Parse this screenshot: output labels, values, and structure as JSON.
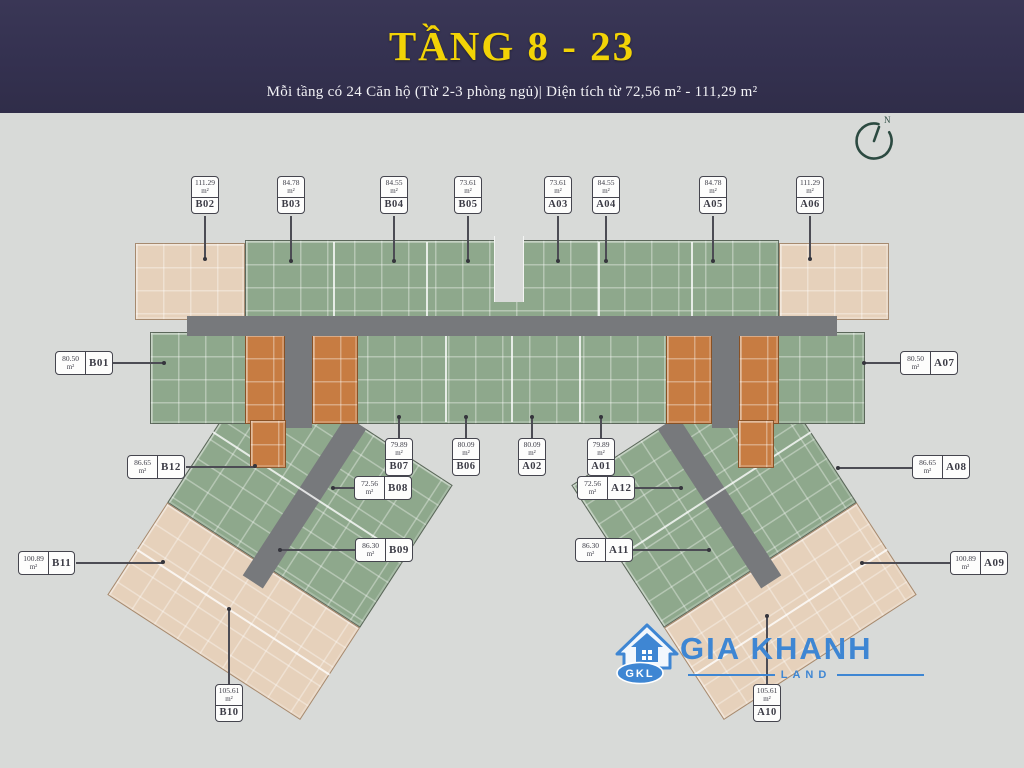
{
  "header": {
    "title": "TẦNG 8 - 23",
    "subtitle": "Mỗi tầng có 24 Căn hộ (Từ 2-3 phòng ngủ)| Diện tích từ 72,56 m²  - 111,29 m²"
  },
  "compass": {
    "label": "N"
  },
  "logo": {
    "name": "GIA KHANH",
    "sub": "LAND",
    "abbr": "GKL",
    "color": "#3e86d3"
  },
  "palette": {
    "header_bg": "#343150",
    "title_gold": "#f2d306",
    "plan_bg": "#d8dad8",
    "unit_green": "#8ea88c",
    "unit_beige": "#e6d1bb",
    "core_orange": "#c77c42",
    "corridor_gray": "#77797c",
    "logo_blue": "#3e86d3"
  },
  "units": [
    {
      "code": "B02",
      "area": "111.29",
      "unit": "m²",
      "style": "v",
      "box": {
        "x": 191,
        "y": 176
      },
      "line": {
        "x": 204,
        "y": 216,
        "w": 1.5,
        "h": 44
      },
      "dot": {
        "x": 205,
        "y": 259
      }
    },
    {
      "code": "B03",
      "area": "84.78",
      "unit": "m²",
      "style": "v",
      "box": {
        "x": 277,
        "y": 176
      },
      "line": {
        "x": 290,
        "y": 216,
        "w": 1.5,
        "h": 46
      },
      "dot": {
        "x": 291,
        "y": 261
      }
    },
    {
      "code": "B04",
      "area": "84.55",
      "unit": "m²",
      "style": "v",
      "box": {
        "x": 380,
        "y": 176
      },
      "line": {
        "x": 393,
        "y": 216,
        "w": 1.5,
        "h": 46
      },
      "dot": {
        "x": 394,
        "y": 261
      }
    },
    {
      "code": "B05",
      "area": "73.61",
      "unit": "m²",
      "style": "v",
      "box": {
        "x": 454,
        "y": 176
      },
      "line": {
        "x": 467,
        "y": 216,
        "w": 1.5,
        "h": 46
      },
      "dot": {
        "x": 468,
        "y": 261
      }
    },
    {
      "code": "A03",
      "area": "73.61",
      "unit": "m²",
      "style": "v",
      "box": {
        "x": 544,
        "y": 176
      },
      "line": {
        "x": 557,
        "y": 216,
        "w": 1.5,
        "h": 46
      },
      "dot": {
        "x": 558,
        "y": 261
      }
    },
    {
      "code": "A04",
      "area": "84.55",
      "unit": "m²",
      "style": "v",
      "box": {
        "x": 592,
        "y": 176
      },
      "line": {
        "x": 605,
        "y": 216,
        "w": 1.5,
        "h": 46
      },
      "dot": {
        "x": 606,
        "y": 261
      }
    },
    {
      "code": "A05",
      "area": "84.78",
      "unit": "m²",
      "style": "v",
      "box": {
        "x": 699,
        "y": 176
      },
      "line": {
        "x": 712,
        "y": 216,
        "w": 1.5,
        "h": 46
      },
      "dot": {
        "x": 713,
        "y": 261
      }
    },
    {
      "code": "A06",
      "area": "111.29",
      "unit": "m²",
      "style": "v",
      "box": {
        "x": 796,
        "y": 176
      },
      "line": {
        "x": 809,
        "y": 216,
        "w": 1.5,
        "h": 44
      },
      "dot": {
        "x": 810,
        "y": 259
      }
    },
    {
      "code": "B01",
      "area": "80.50",
      "unit": "m²",
      "style": "h",
      "box": {
        "x": 55,
        "y": 351
      },
      "line": {
        "x": 113,
        "y": 362,
        "w": 52,
        "h": 1.5
      },
      "dot": {
        "x": 164,
        "y": 363
      }
    },
    {
      "code": "A07",
      "area": "80.50",
      "unit": "m²",
      "style": "h",
      "box": {
        "x": 900,
        "y": 351
      },
      "line": {
        "x": 864,
        "y": 362,
        "w": 36,
        "h": 1.5
      },
      "dot": {
        "x": 864,
        "y": 363
      }
    },
    {
      "code": "B12",
      "area": "86.65",
      "unit": "m²",
      "style": "h",
      "box": {
        "x": 127,
        "y": 455
      },
      "line": {
        "x": 186,
        "y": 466,
        "w": 69,
        "h": 1.5
      },
      "dot": {
        "x": 255,
        "y": 466
      }
    },
    {
      "code": "A08",
      "area": "86.65",
      "unit": "m²",
      "style": "h",
      "box": {
        "x": 912,
        "y": 455
      },
      "line": {
        "x": 838,
        "y": 467,
        "w": 74,
        "h": 1.5
      },
      "dot": {
        "x": 838,
        "y": 468
      }
    },
    {
      "code": "B07",
      "area": "79.89",
      "unit": "m²",
      "style": "v",
      "box": {
        "x": 385,
        "y": 438
      },
      "line": {
        "x": 398,
        "y": 417,
        "w": 1.5,
        "h": 21
      },
      "dot": {
        "x": 399,
        "y": 417
      }
    },
    {
      "code": "B06",
      "area": "80.09",
      "unit": "m²",
      "style": "v",
      "box": {
        "x": 452,
        "y": 438
      },
      "line": {
        "x": 465,
        "y": 417,
        "w": 1.5,
        "h": 21
      },
      "dot": {
        "x": 466,
        "y": 417
      }
    },
    {
      "code": "A02",
      "area": "80.09",
      "unit": "m²",
      "style": "v",
      "box": {
        "x": 518,
        "y": 438
      },
      "line": {
        "x": 531,
        "y": 417,
        "w": 1.5,
        "h": 21
      },
      "dot": {
        "x": 532,
        "y": 417
      }
    },
    {
      "code": "A01",
      "area": "79.89",
      "unit": "m²",
      "style": "v",
      "box": {
        "x": 587,
        "y": 438
      },
      "line": {
        "x": 600,
        "y": 417,
        "w": 1.5,
        "h": 21
      },
      "dot": {
        "x": 601,
        "y": 417
      }
    },
    {
      "code": "B08",
      "area": "72.56",
      "unit": "m²",
      "style": "h",
      "box": {
        "x": 354,
        "y": 476
      },
      "line": {
        "x": 334,
        "y": 487,
        "w": 20,
        "h": 1.5
      },
      "dot": {
        "x": 333,
        "y": 488
      }
    },
    {
      "code": "A12",
      "area": "72.56",
      "unit": "m²",
      "style": "h",
      "box": {
        "x": 577,
        "y": 476
      },
      "line": {
        "x": 635,
        "y": 487,
        "w": 46,
        "h": 1.5
      },
      "dot": {
        "x": 681,
        "y": 488
      }
    },
    {
      "code": "B09",
      "area": "86.30",
      "unit": "m²",
      "style": "h",
      "box": {
        "x": 355,
        "y": 538
      },
      "line": {
        "x": 281,
        "y": 549,
        "w": 74,
        "h": 1.5
      },
      "dot": {
        "x": 280,
        "y": 550
      }
    },
    {
      "code": "A11",
      "area": "86.30",
      "unit": "m²",
      "style": "h",
      "box": {
        "x": 575,
        "y": 538
      },
      "line": {
        "x": 633,
        "y": 549,
        "w": 76,
        "h": 1.5
      },
      "dot": {
        "x": 709,
        "y": 550
      }
    },
    {
      "code": "B11",
      "area": "100.89",
      "unit": "m²",
      "style": "h",
      "box": {
        "x": 18,
        "y": 551
      },
      "line": {
        "x": 76,
        "y": 562,
        "w": 87,
        "h": 1.5
      },
      "dot": {
        "x": 163,
        "y": 562
      }
    },
    {
      "code": "A09",
      "area": "100.89",
      "unit": "m²",
      "style": "h",
      "box": {
        "x": 950,
        "y": 551
      },
      "line": {
        "x": 863,
        "y": 562,
        "w": 87,
        "h": 1.5
      },
      "dot": {
        "x": 862,
        "y": 563
      }
    },
    {
      "code": "B10",
      "area": "105.61",
      "unit": "m²",
      "style": "v",
      "box": {
        "x": 215,
        "y": 684
      },
      "line": {
        "x": 228,
        "y": 609,
        "w": 1.5,
        "h": 75
      },
      "dot": {
        "x": 229,
        "y": 609
      }
    },
    {
      "code": "A10",
      "area": "105.61",
      "unit": "m²",
      "style": "v",
      "box": {
        "x": 753,
        "y": 684
      },
      "line": {
        "x": 766,
        "y": 616,
        "w": 1.5,
        "h": 68
      },
      "dot": {
        "x": 767,
        "y": 616
      }
    }
  ]
}
